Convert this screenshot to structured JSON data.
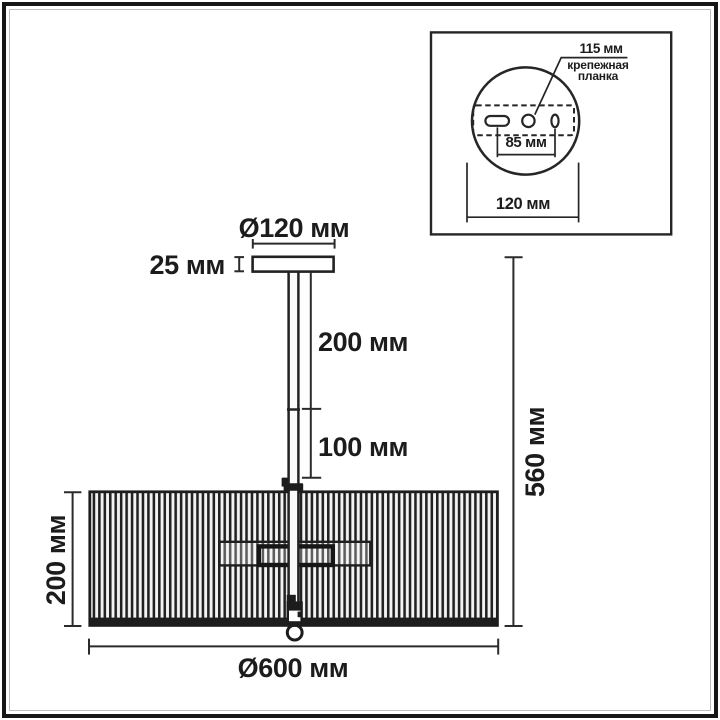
{
  "main_view": {
    "canopy_diameter_label": "Ø120 мм",
    "canopy_height_label": "25 мм",
    "upper_rod_label": "200 мм",
    "lower_rod_label": "100 мм",
    "shade_height_label": "200 мм",
    "overall_height_label": "560 мм",
    "shade_diameter_label": "Ø600 мм"
  },
  "inset_view": {
    "plate_width_label": "115 мм",
    "bracket_caption_line1": "крепежная",
    "bracket_caption_line2": "планка",
    "hole_spacing_label": "85 мм",
    "plate_diameter_label": "120 мм"
  },
  "colors": {
    "line": "#242424",
    "background": "#ffffff"
  }
}
